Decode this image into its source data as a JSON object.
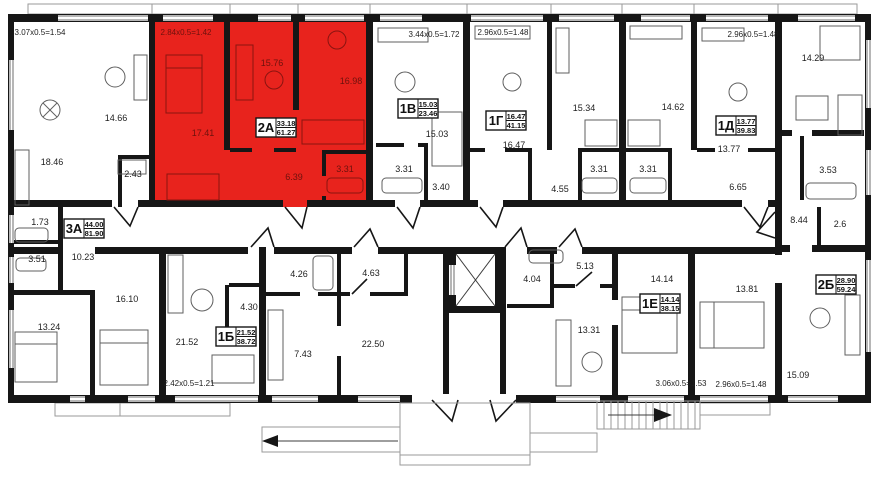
{
  "colors": {
    "highlight": "#e8231d",
    "wall": "#161616",
    "red_text": "#6d120d"
  },
  "apartments": [
    {
      "id": "3А",
      "living": "44.00",
      "total": "81.90"
    },
    {
      "id": "2А",
      "living": "33.18",
      "total": "61.27",
      "highlighted": true
    },
    {
      "id": "1В",
      "living": "15.03",
      "total": "23.46"
    },
    {
      "id": "1Г",
      "living": "16.47",
      "total": "41.15"
    },
    {
      "id": "1Д",
      "living": "13.77",
      "total": "39.83"
    },
    {
      "id": "1Б",
      "living": "21.52",
      "total": "38.72"
    },
    {
      "id": "1Е",
      "living": "14.14",
      "total": "38.15"
    },
    {
      "id": "2Б",
      "living": "28.90",
      "total": "59.24"
    }
  ],
  "rooms": {
    "a3_room1": "18.46",
    "a3_kitchen": "14.66",
    "a3_pantry": "2.43",
    "a3_wc": "1.73",
    "a3_bath": "3.51",
    "a3_hall": "10.23",
    "a3_room2": "16.10",
    "a3_room3": "13.24",
    "a2_room1": "17.41",
    "a2_room2": "15.76",
    "a2_kitchen": "16.98",
    "a2_hall": "6.39",
    "a2_bath": "3.31",
    "v1_room": "15.03",
    "v1_bath": "3.31",
    "v1_hall": "3.40",
    "g1_room": "16.47",
    "g1_kitchen": "15.34",
    "g1_bath": "3.31",
    "g1_hall": "4.55",
    "d1_kitchen": "14.62",
    "d1_bath": "3.31",
    "d1_room": "13.77",
    "d1_hall": "6.65",
    "b1_room": "21.52",
    "b1_hall": "4.30",
    "s1_bath": "4.26",
    "s1_hall": "4.63",
    "s1_kitchen": "7.43",
    "s1_room": "22.50",
    "e1_bath": "4.04",
    "e1_hall": "5.13",
    "e1_kitchen": "13.31",
    "e1_room": "14.14",
    "b2_kitchen": "14.29",
    "b2_bath": "3.53",
    "b2_hall": "8.44",
    "b2_closet": "2.6",
    "b2_room1": "13.81",
    "b2_room2": "15.09"
  },
  "balconies": {
    "bd1": "3.07x0.5=1.54",
    "bd2": "2.84x0.5=1.42",
    "bd3": "3.44x0.5=1.72",
    "bd4": "2.96x0.5=1.48",
    "bd5": "2.96x0.5=1.48",
    "bd6": "2.42x0.5=1.21",
    "bd7": "3.06x0.5=1.53",
    "bd8": "2.96x0.5=1.48"
  }
}
